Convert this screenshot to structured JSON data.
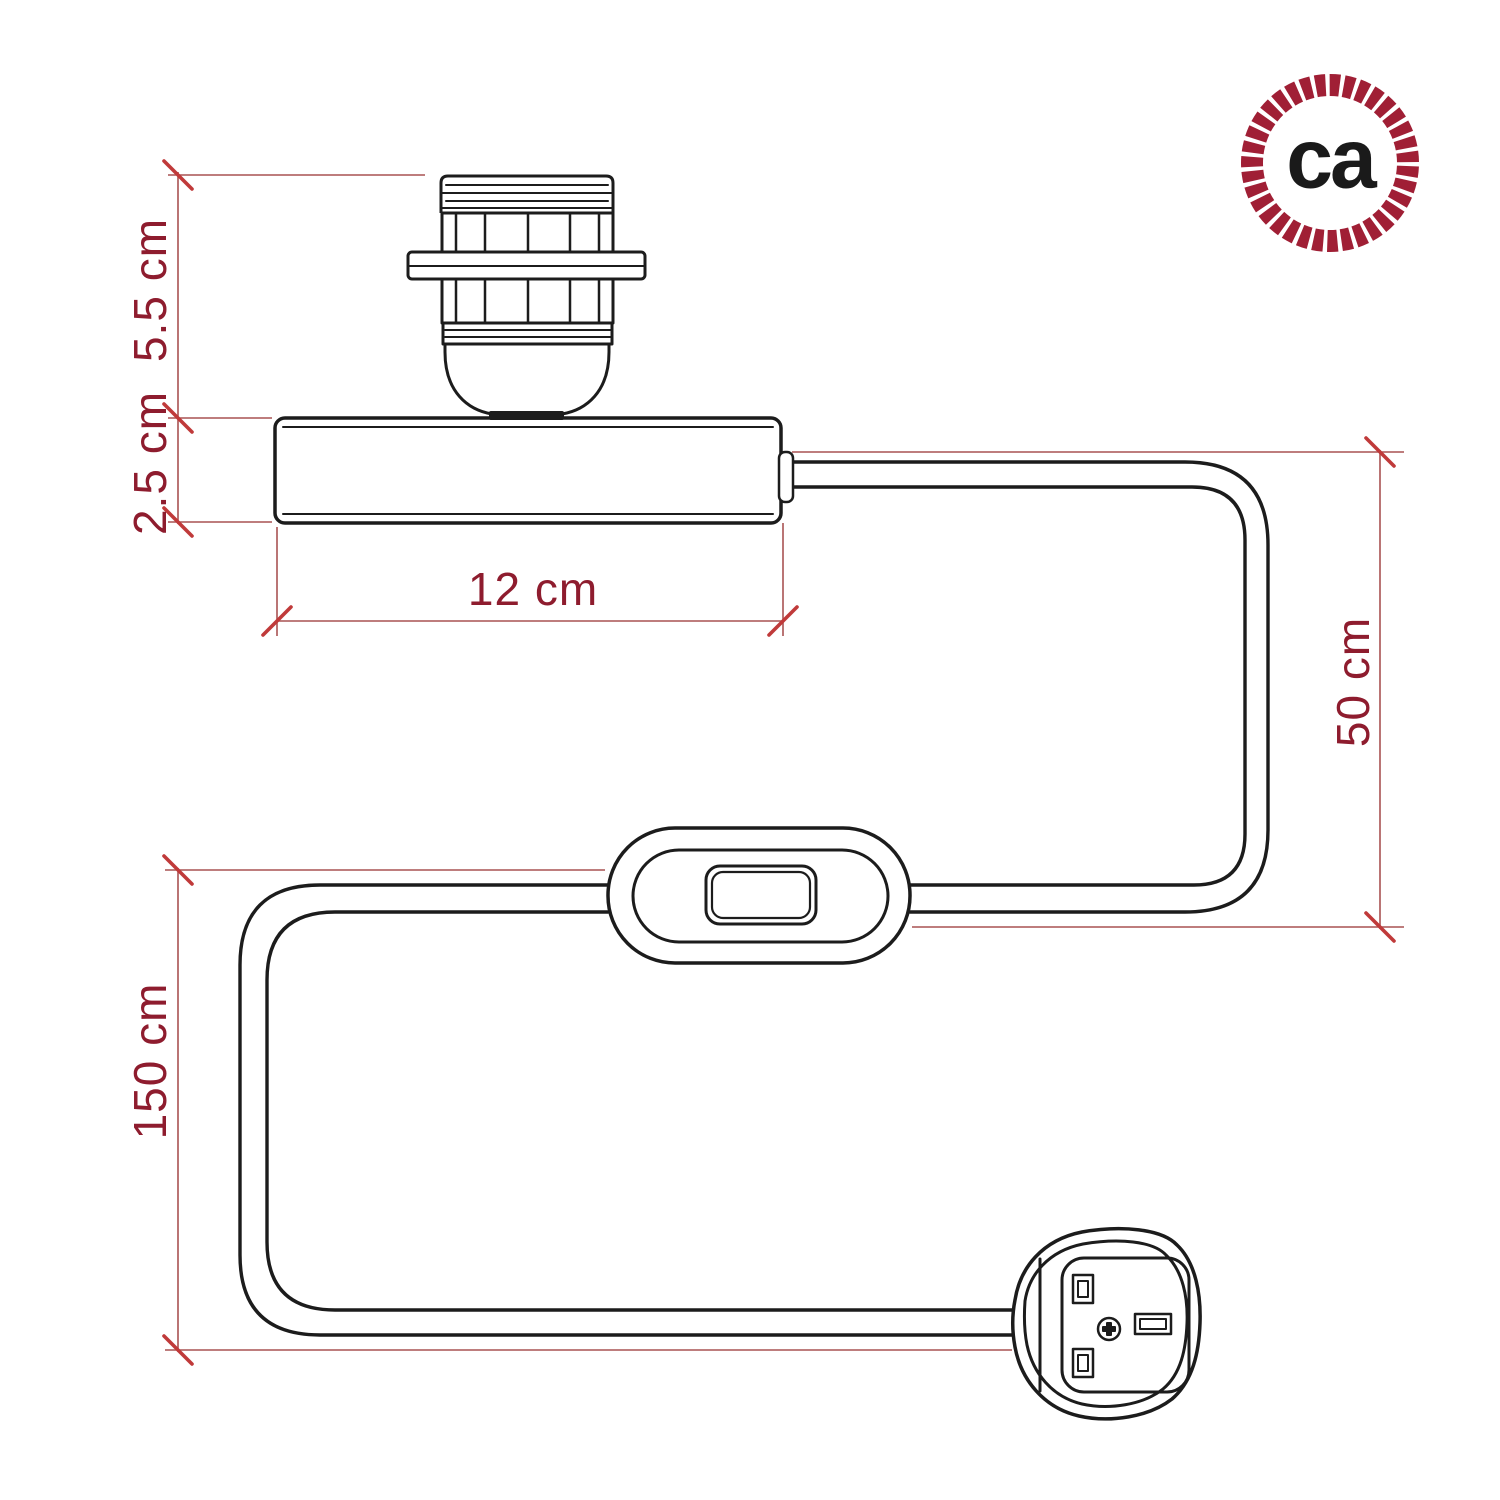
{
  "figure": {
    "description": "Technical dimension drawing of a table-lamp cord kit: E27 lamp holder with shade ring mounted on a cylindrical base, power cable with in-line rocker switch and UK fused plug",
    "units": "cm"
  },
  "colors": {
    "background": "#ffffff",
    "ink": "#1c1c1c",
    "dim-line": "#a85252",
    "tick": "#c03a3a",
    "dim-label": "#8e1c2e",
    "brand": "#a01f35",
    "logo-text": "#1a1a1a"
  },
  "dimensions": {
    "socket_height": "5.5 cm",
    "base_height": "2.5 cm",
    "base_length": "12 cm",
    "cable_to_switch": "50 cm",
    "cable_to_plug": "150 cm"
  },
  "logo": {
    "text": "ca"
  },
  "parts": [
    "lamp holder with shade ring",
    "cylindrical lamp base",
    "power cable",
    "in-line rocker switch",
    "uk three-pin plug"
  ]
}
